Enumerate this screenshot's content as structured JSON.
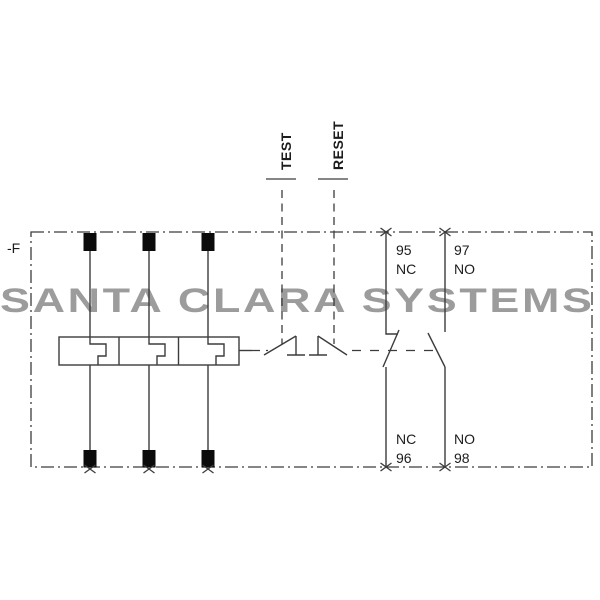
{
  "watermark": "SANTA CLARA SYSTEMS",
  "device_label": "-F",
  "controls": {
    "test_label": "TEST",
    "reset_label": "RESET"
  },
  "aux_contacts": {
    "nc": {
      "top_terminal": "95",
      "top_type": "NC",
      "bottom_type": "NC",
      "bottom_terminal": "96"
    },
    "no": {
      "top_terminal": "97",
      "top_type": "NO",
      "bottom_type": "NO",
      "bottom_terminal": "98"
    }
  },
  "icons": {
    "terminal_marker": "x-cross",
    "power_terminal": "black-square"
  },
  "colors": {
    "background": "#ffffff",
    "line": "#3c3c3c",
    "terminal": "#0b0b0b",
    "label": "#1c1c1c",
    "watermark": "#9c9c9c"
  }
}
